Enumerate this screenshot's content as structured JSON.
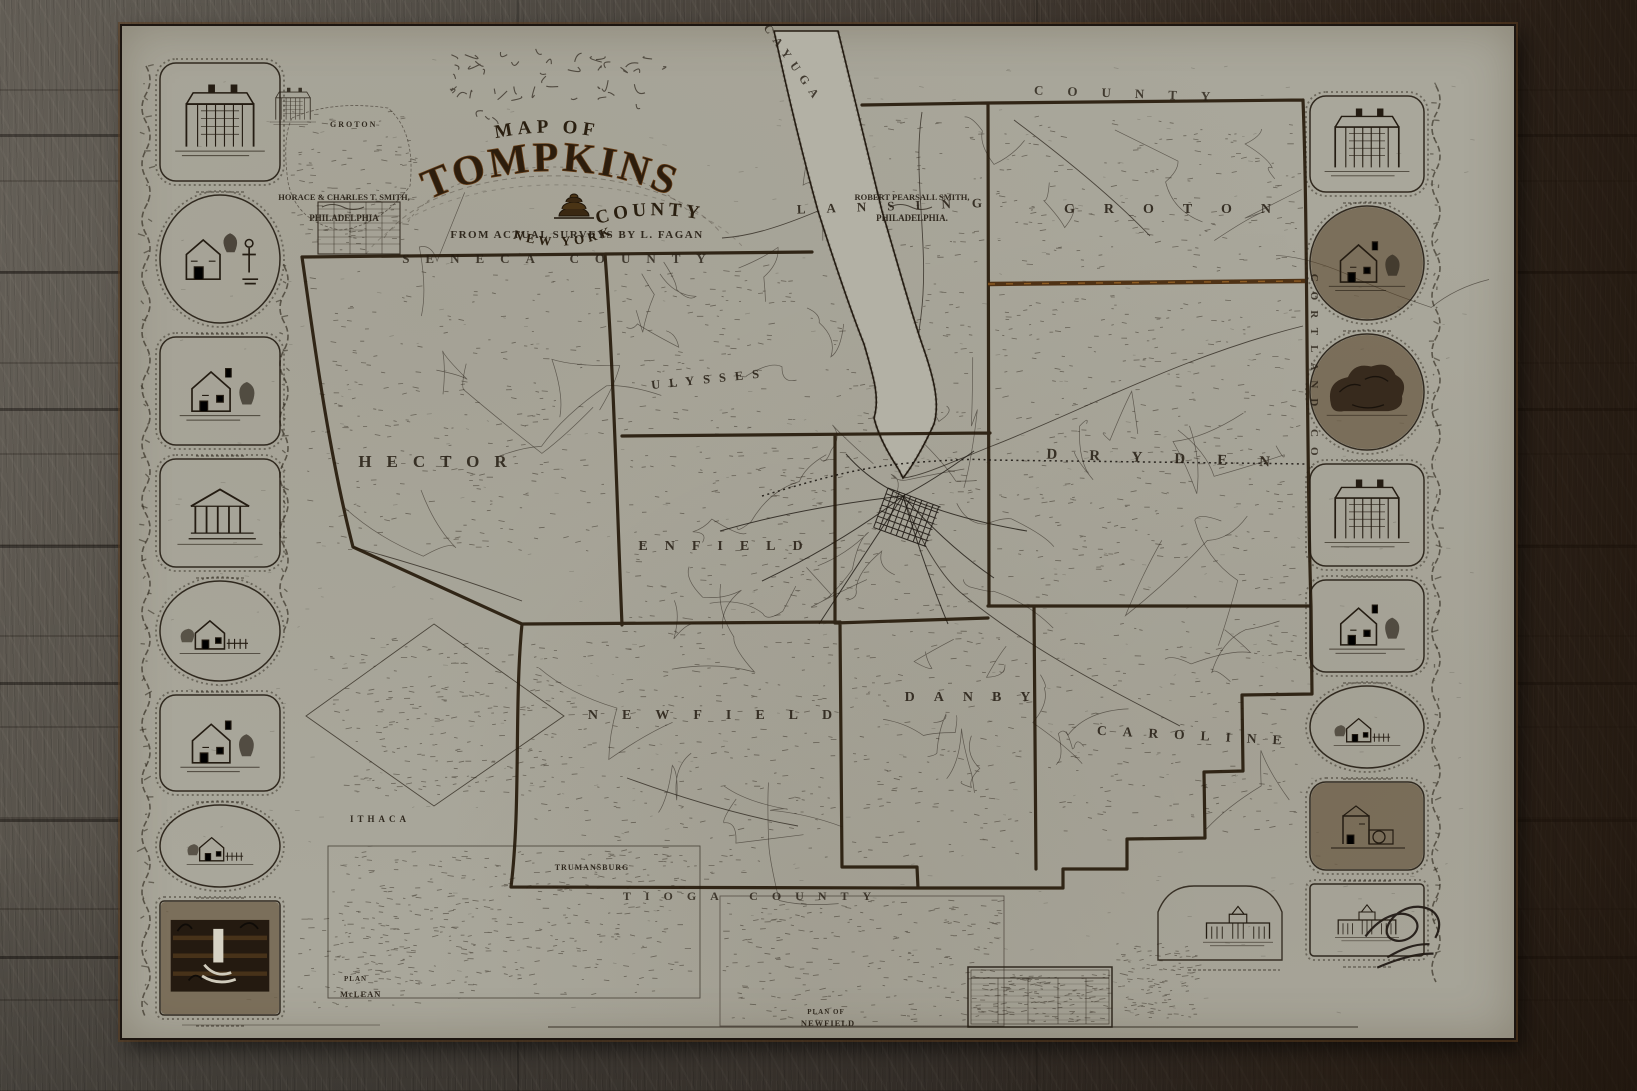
{
  "map": {
    "title": {
      "prefix": "MAP OF",
      "main": "TOMPKINS",
      "suffix": "COUNTY",
      "state": "NEW YORK"
    },
    "imprint": {
      "left_name": "HORACE & CHARLES T. SMITH,",
      "left_city": "PHILADELPHIA",
      "right_name": "ROBERT PEARSALL SMITH,",
      "right_city": "PHILADELPHIA.",
      "survey": "FROM ACTUAL SURVEYS BY L. FAGAN"
    },
    "townships": [
      "HECTOR",
      "ULYSSES",
      "ENFIELD",
      "NEWFIELD",
      "DANBY",
      "CAROLINE",
      "DRYDEN",
      "GROTON",
      "LANSING"
    ],
    "counties": [
      "SENECA COUNTY",
      "CAYUGA",
      "COUNTY",
      "CORTLAND CO.",
      "TIOGA COUNTY"
    ],
    "insets": {
      "groton": "GROTON",
      "ithaca": "ITHACA",
      "trumansburg": "TRUMANSBURG",
      "mclean_1": "PLAN",
      "mclean_2": "McLEAN",
      "newfield_1": "PLAN OF",
      "newfield_2": "NEWFIELD"
    },
    "colors": {
      "paper": "#a9a79b",
      "ink": "#241c12",
      "boundary": "#241708",
      "accent_brown": "#6b4520",
      "lake": "#b3b1a5",
      "wood_light": "#564f48",
      "wood_dark": "#2b2218"
    }
  },
  "vignettes": {
    "left": [
      {
        "name": "college-building-vignette"
      },
      {
        "name": "house-and-statue-vignette"
      },
      {
        "name": "villa-with-trees-vignette"
      },
      {
        "name": "greek-temple-vignette"
      },
      {
        "name": "cottage-vignette"
      },
      {
        "name": "residence-vignette"
      },
      {
        "name": "farmhouse-vignette"
      },
      {
        "name": "waterfall-vignette"
      }
    ],
    "right": [
      {
        "name": "portico-building-vignette"
      },
      {
        "name": "homestead-vignette"
      },
      {
        "name": "wooded-grove-vignette"
      },
      {
        "name": "public-building-vignette"
      },
      {
        "name": "residence-vignette"
      },
      {
        "name": "cottage-vignette"
      },
      {
        "name": "mill-vignette"
      },
      {
        "name": "columned-hall-vignette"
      }
    ]
  }
}
